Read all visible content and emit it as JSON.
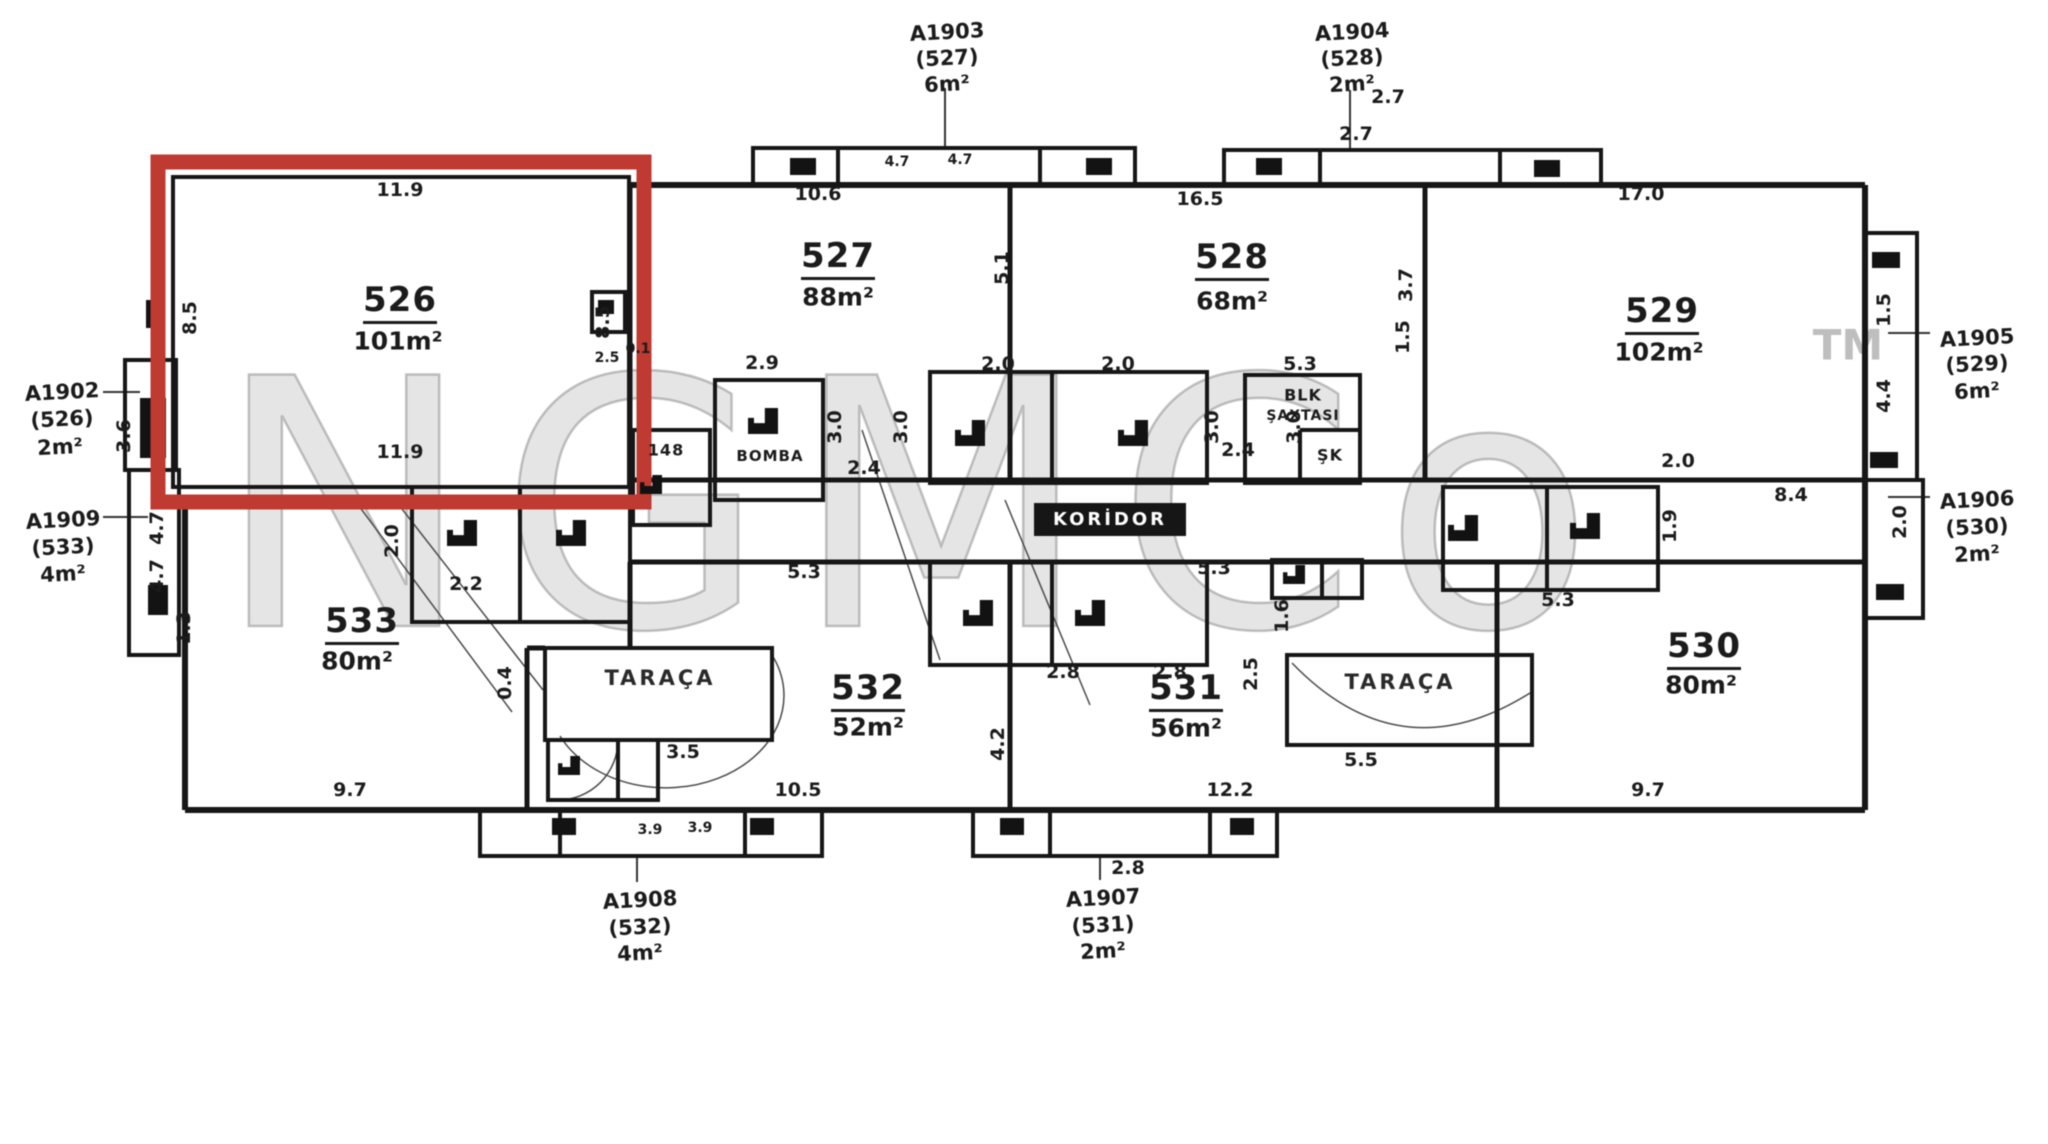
{
  "colors": {
    "highlight_red": "#bf3a31",
    "wall_black": "#161616",
    "watermark_gray": "#7d7d7d"
  },
  "watermark": {
    "text": "NGMCo",
    "tm": "TM"
  },
  "rooms": [
    {
      "num": "526",
      "area": "101m²"
    },
    {
      "num": "527",
      "area": "88m²"
    },
    {
      "num": "528",
      "area": "68m²"
    },
    {
      "num": "529",
      "area": "102m²"
    },
    {
      "num": "530",
      "area": "80m²"
    },
    {
      "num": "531",
      "area": "56m²"
    },
    {
      "num": "532",
      "area": "52m²"
    },
    {
      "num": "533",
      "area": "80m²"
    }
  ],
  "callouts": [
    {
      "id": "A1902",
      "ref": "(526)",
      "area": "2m²"
    },
    {
      "id": "A1903",
      "ref": "(527)",
      "area": "6m²"
    },
    {
      "id": "A1904",
      "ref": "(528)",
      "area": "2m²"
    },
    {
      "id": "A1905",
      "ref": "(529)",
      "area": "6m²"
    },
    {
      "id": "A1906",
      "ref": "(530)",
      "area": "2m²"
    },
    {
      "id": "A1907",
      "ref": "(531)",
      "area": "2m²"
    },
    {
      "id": "A1908",
      "ref": "(532)",
      "area": "4m²"
    },
    {
      "id": "A1909",
      "ref": "(533)",
      "area": "4m²"
    }
  ],
  "labels": {
    "koridor": "KORİDOR",
    "taraca_left": "TARAÇA",
    "taraca_right": "TARAÇA",
    "bomba": "BOMBA",
    "blk": "BLK",
    "saxtasi": "ŞAXTASI",
    "room148": "148",
    "sk": "ŞK"
  },
  "dims": [
    "11.9",
    "8.5",
    "8.5",
    "11.9",
    "3.6",
    "4.7",
    "4.7",
    "1.3",
    "2.5",
    "0.1",
    "2.9",
    "10.6",
    "4.7",
    "4.7",
    "16.5",
    "2.7",
    "2.7",
    "17.0",
    "5.1",
    "3.7",
    "1.5",
    "3.0",
    "3.0",
    "2.4",
    "2.0",
    "2.0",
    "3.0",
    "3.0",
    "5.3",
    "2.4",
    "5.3",
    "5.3",
    "2.8",
    "2.8",
    "4.2",
    "12.2",
    "2.8",
    "10.5",
    "9.7",
    "3.9",
    "3.9",
    "2.2",
    "2.0",
    "5.3",
    "2.0",
    "1.9",
    "8.4",
    "5.5",
    "2.5",
    "3.5",
    "0.4",
    "9.7",
    "1.6",
    "4.4",
    "1.5",
    "2.0"
  ]
}
